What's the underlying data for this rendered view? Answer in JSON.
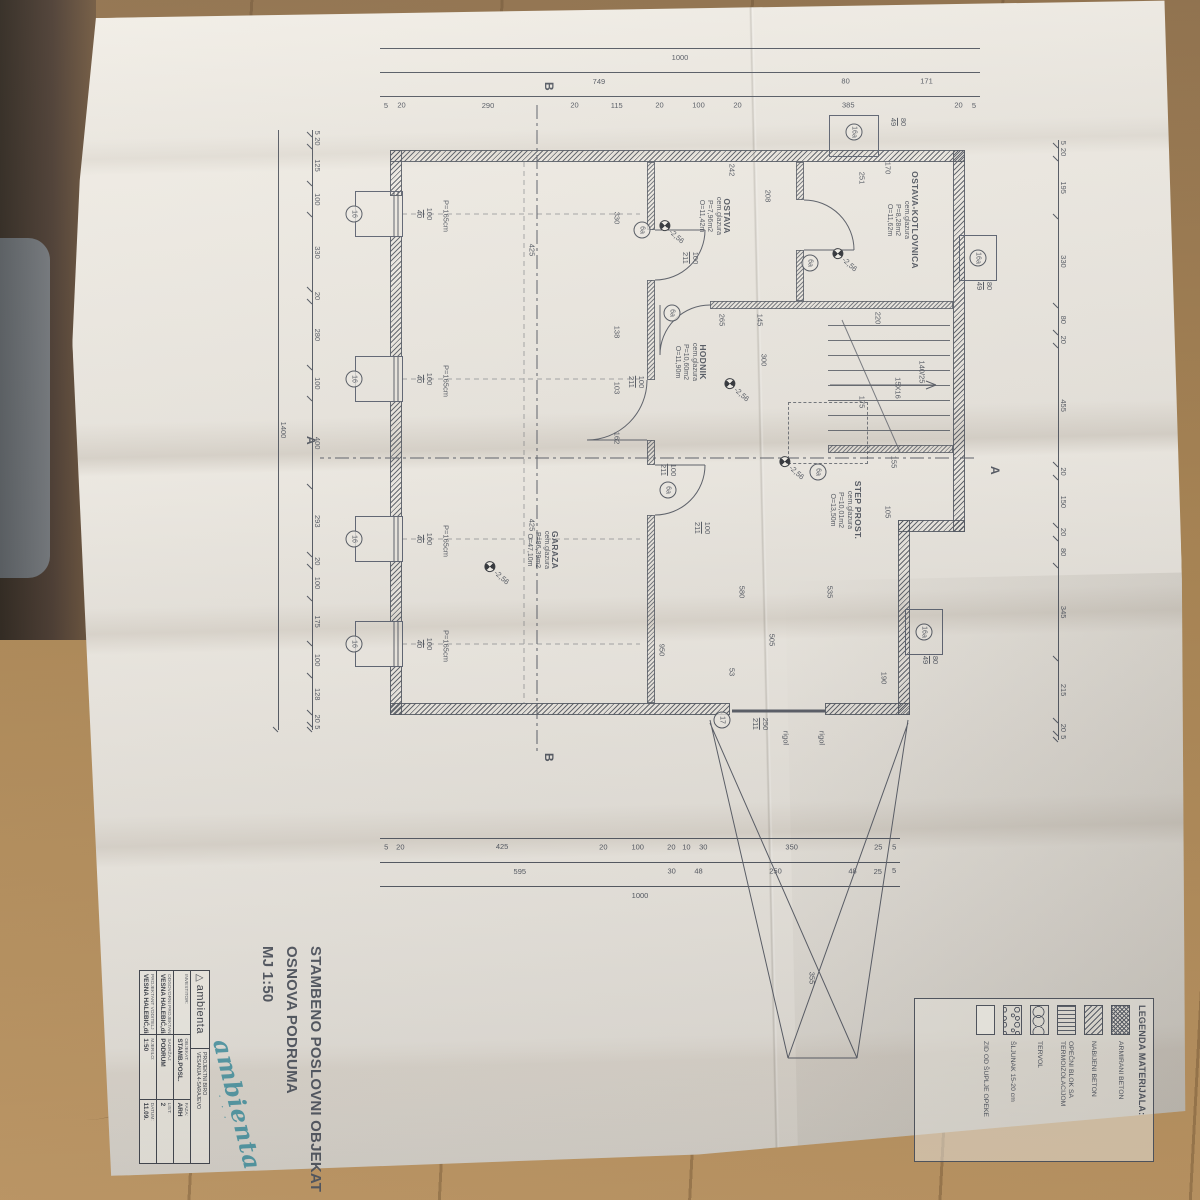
{
  "title": {
    "line1": "STAMBENO POSLOVNI OBJEKAT",
    "line2": "OSNOVA PODRUMA",
    "line3": "MJ 1:50"
  },
  "title_block": {
    "logo_symbol": "△",
    "logo_text": "ambienta",
    "firm_line1": "PROJEKTNI BIRO",
    "firm_line2": "VESANJA 4-SARAJEVO",
    "investitor_label": "INVESTITOR:",
    "role1_label": "ODGOVORNI PROJEKTANT",
    "role1_value": "VESNA HALEBIĆ,dia",
    "role2_label": "PROJEKTANT VODITELJ",
    "role2_value": "VESNA HALEBIĆ,dia",
    "objekat_label": "OBJEKAT:",
    "objekat_value": "STAMB.POSL.",
    "sadrzaj_label": "SADRŽAJ:",
    "sadrzaj_value": "PODRUM",
    "faza_label": "FAZA:",
    "faza_value": "ARH",
    "mjerilo_label": "MJERILO:",
    "mjerilo_value": "1:50",
    "datum_label": "DATUM:",
    "datum_value": "11.09.",
    "list_label": "LIST:",
    "list_value": "2",
    "stamp_text": "ambienta"
  },
  "legend": {
    "heading": "LEGENDA MATERIJALA:",
    "items": [
      {
        "label": "ARMIRANI BETON"
      },
      {
        "label": "NABIJENI BETON"
      },
      {
        "label": "OPEČNI BLOK SA TERMOIZOLACIJOM"
      },
      {
        "label": "TERVOL"
      },
      {
        "label": "ŠLJUNAK 15-20 cm"
      },
      {
        "label": "ZID OD ŠUPLJE OPEKE"
      }
    ]
  },
  "plan": {
    "level_value": "-2,56",
    "rooms": {
      "garaza": {
        "name": "GARAZA",
        "finish": "cem.glazura",
        "area": "P=86,39m2",
        "perimeter": "O=47,10m"
      },
      "ostava": {
        "name": "OSTAVA",
        "finish": "cem.glazura",
        "area": "P=7,96m2",
        "perimeter": "O=11,42m"
      },
      "kotlovnica": {
        "name": "OSTAVA-KOTLOVNICA",
        "finish": "cem.glazura",
        "area": "P=8,28m2",
        "perimeter": "O=11,62m"
      },
      "hodnik": {
        "name": "HODNIK",
        "finish": "cem.glazura",
        "area": "P=10,60m2",
        "perimeter": "O=11,90m"
      },
      "step": {
        "name": "STEP PROST.",
        "finish": "cem.glazura",
        "area": "P=10,01m2",
        "perimeter": "O=13,50m"
      }
    },
    "sections": {
      "a": "A",
      "b": "B"
    },
    "levels": [
      {
        "x": 553,
        "y": 663
      },
      {
        "x": 212,
        "y": 488
      },
      {
        "x": 240,
        "y": 315
      },
      {
        "x": 370,
        "y": 423
      },
      {
        "x": 448,
        "y": 368
      }
    ],
    "tags": [
      {
        "t": "16",
        "x": 194,
        "y": 806
      },
      {
        "t": "16",
        "x": 359,
        "y": 806
      },
      {
        "t": "16",
        "x": 519,
        "y": 806
      },
      {
        "t": "16",
        "x": 624,
        "y": 806
      },
      {
        "t": "16a",
        "x": 112,
        "y": 306
      },
      {
        "t": "16a",
        "x": 238,
        "y": 182
      },
      {
        "t": "16a",
        "x": 612,
        "y": 236
      },
      {
        "t": "17",
        "x": 700,
        "y": 438
      },
      {
        "t": "6a",
        "x": 293,
        "y": 488
      },
      {
        "t": "6a",
        "x": 243,
        "y": 350
      },
      {
        "t": "6a",
        "x": 452,
        "y": 342
      },
      {
        "t": "6a",
        "x": 470,
        "y": 492
      },
      {
        "t": "6a",
        "x": 210,
        "y": 518
      }
    ],
    "scatter": [
      {
        "t": "425",
        "x": 230,
        "y": 628
      },
      {
        "t": "425",
        "x": 505,
        "y": 628
      },
      {
        "t": "950",
        "x": 630,
        "y": 498
      },
      {
        "t": "505",
        "x": 620,
        "y": 388
      },
      {
        "t": "300",
        "x": 340,
        "y": 396
      },
      {
        "t": "265",
        "x": 300,
        "y": 438
      },
      {
        "t": "242",
        "x": 150,
        "y": 428
      },
      {
        "t": "208",
        "x": 176,
        "y": 392
      },
      {
        "t": "251",
        "x": 158,
        "y": 298
      },
      {
        "t": "170",
        "x": 148,
        "y": 272
      },
      {
        "t": "145",
        "x": 300,
        "y": 400
      },
      {
        "t": "220",
        "x": 298,
        "y": 282
      },
      {
        "t": "155",
        "x": 442,
        "y": 266
      },
      {
        "t": "105",
        "x": 492,
        "y": 272
      },
      {
        "t": "580",
        "x": 572,
        "y": 418
      },
      {
        "t": "535",
        "x": 572,
        "y": 330
      },
      {
        "t": "330",
        "x": 198,
        "y": 543
      },
      {
        "t": "138",
        "x": 312,
        "y": 543
      },
      {
        "t": "103",
        "x": 368,
        "y": 543
      },
      {
        "t": "162",
        "x": 418,
        "y": 543
      },
      {
        "t": "53",
        "x": 652,
        "y": 428
      },
      {
        "t": "190",
        "x": 658,
        "y": 276
      },
      {
        "t": "175",
        "x": 382,
        "y": 298
      },
      {
        "t": "140/25",
        "x": 352,
        "y": 238
      },
      {
        "t": "15X16",
        "x": 368,
        "y": 262
      },
      {
        "t": "355",
        "x": 958,
        "y": 348
      },
      {
        "t": "rigol",
        "x": 718,
        "y": 338
      },
      {
        "t": "rigol",
        "x": 718,
        "y": 374
      },
      {
        "t": "100",
        "x": 238,
        "y": 470,
        "f": "211"
      },
      {
        "t": "100",
        "x": 362,
        "y": 524,
        "f": "211"
      },
      {
        "t": "100",
        "x": 450,
        "y": 492,
        "f": "211"
      },
      {
        "t": "100",
        "x": 508,
        "y": 458,
        "f": "211"
      },
      {
        "t": "250",
        "x": 704,
        "y": 400,
        "f": "211"
      },
      {
        "t": "100",
        "x": 194,
        "y": 736,
        "f": "40"
      },
      {
        "t": "100",
        "x": 359,
        "y": 736,
        "f": "40"
      },
      {
        "t": "100",
        "x": 519,
        "y": 736,
        "f": "40"
      },
      {
        "t": "100",
        "x": 624,
        "y": 736,
        "f": "40"
      },
      {
        "t": "80",
        "x": 102,
        "y": 262,
        "f": "49"
      },
      {
        "t": "80",
        "x": 266,
        "y": 176,
        "f": "49"
      },
      {
        "t": "80",
        "x": 640,
        "y": 230,
        "f": "49"
      },
      {
        "t": "P=165cm",
        "x": 196,
        "y": 714
      },
      {
        "t": "P=165cm",
        "x": 361,
        "y": 714
      },
      {
        "t": "P=165cm",
        "x": 521,
        "y": 714
      },
      {
        "t": "P=165cm",
        "x": 626,
        "y": 714
      }
    ],
    "chains": {
      "left_outer": [
        "1000"
      ],
      "left_mid": [
        "171",
        "80",
        "749"
      ],
      "left_inner": [
        "5",
        "20",
        "385",
        "20",
        "100",
        "20",
        "115",
        "20",
        "290",
        "20",
        "5"
      ],
      "top_inner": [
        "5",
        "20",
        "195",
        "330",
        "80",
        "20",
        "455",
        "20",
        "150",
        "20",
        "80",
        "345",
        "215",
        "20",
        "5"
      ],
      "right_inner": [
        "5",
        "25",
        "350",
        "30",
        "10",
        "20",
        "100",
        "20",
        "425",
        "20",
        "5"
      ],
      "right_mid": [
        "5",
        "25",
        "48",
        "250",
        "48",
        "30",
        "595"
      ],
      "right_outer": [
        "1000"
      ],
      "bottom_inner": [
        "5",
        "20",
        "125",
        "100",
        "330",
        "20",
        "280",
        "100",
        "400",
        "293",
        "20",
        "100",
        "175",
        "100",
        "128",
        "20",
        "5"
      ],
      "bottom_outer": [
        "1400"
      ]
    }
  }
}
